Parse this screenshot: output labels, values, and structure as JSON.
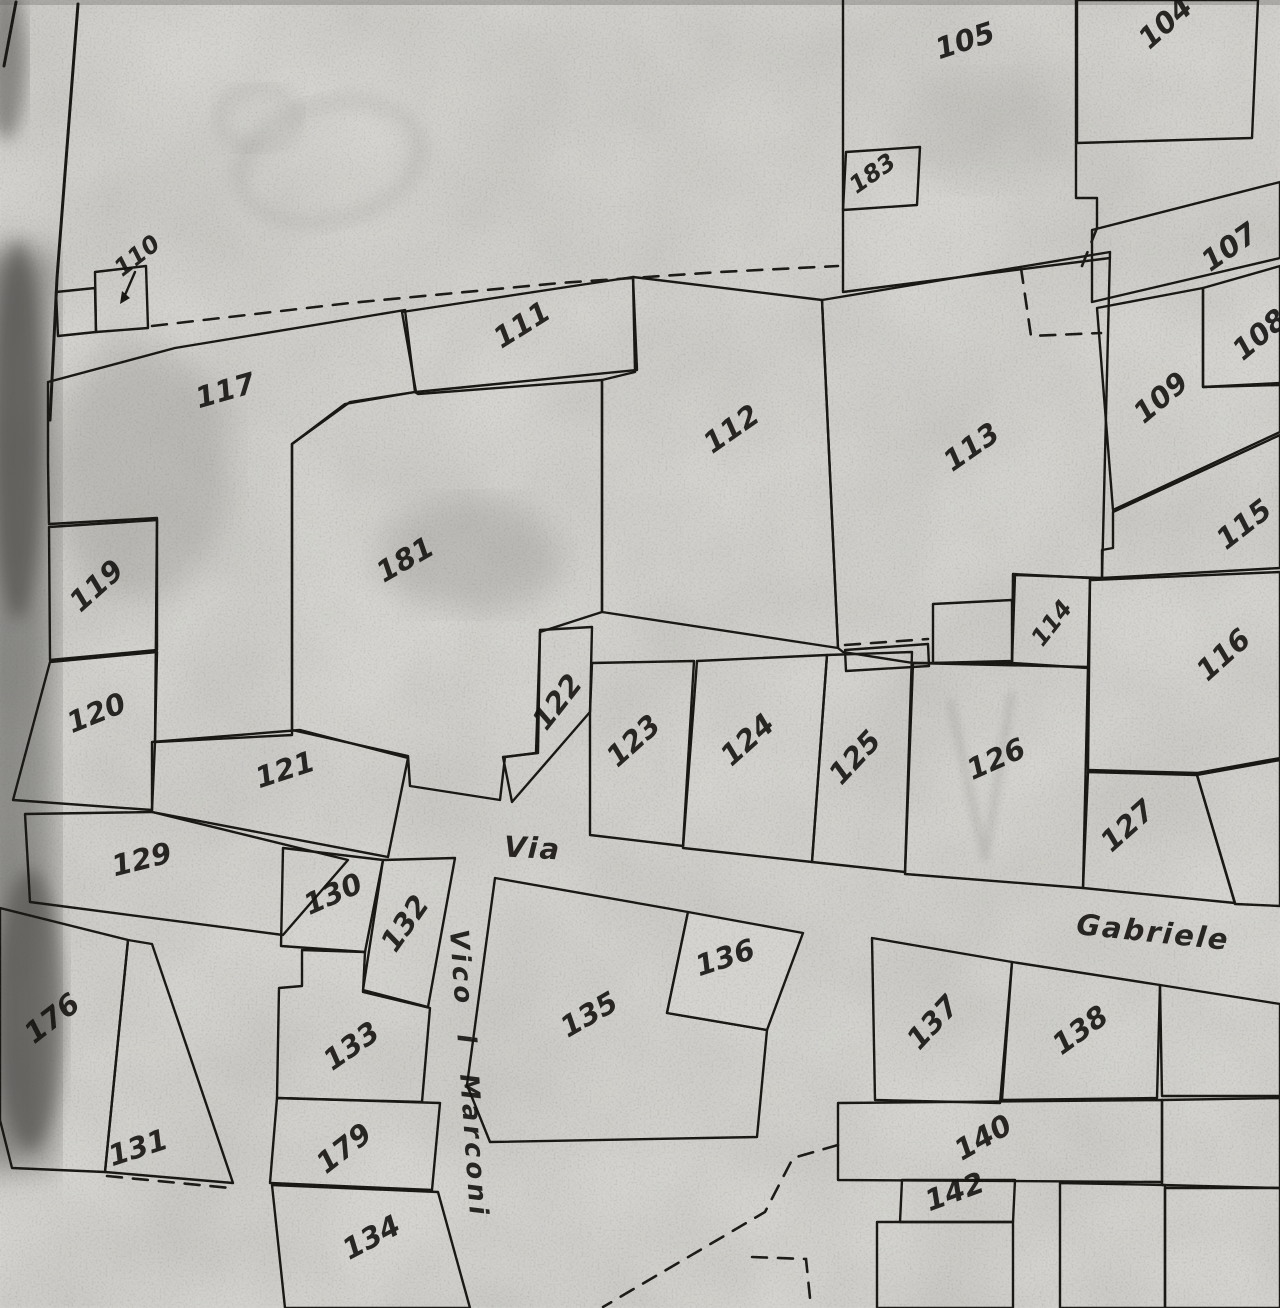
{
  "map": {
    "streets": {
      "via": "Via",
      "gabriele": "Gabriele",
      "vico_marconi": "Vico i Marconi"
    },
    "parcels": [
      {
        "label": "104",
        "hatched": true
      },
      {
        "label": "105",
        "hatched": false
      },
      {
        "label": "183",
        "hatched": true
      },
      {
        "label": "107",
        "hatched": true
      },
      {
        "label": "108",
        "hatched": true
      },
      {
        "label": "109",
        "hatched": true
      },
      {
        "label": "110",
        "hatched": false
      },
      {
        "label": "111",
        "hatched": true
      },
      {
        "label": "112",
        "hatched": false
      },
      {
        "label": "113",
        "hatched": false
      },
      {
        "label": "114",
        "hatched": true
      },
      {
        "label": "115",
        "hatched": true
      },
      {
        "label": "116",
        "hatched": true
      },
      {
        "label": "117",
        "hatched": true
      },
      {
        "label": "119",
        "hatched": true
      },
      {
        "label": "120",
        "hatched": true
      },
      {
        "label": "121",
        "hatched": true
      },
      {
        "label": "122",
        "hatched": true
      },
      {
        "label": "123",
        "hatched": true
      },
      {
        "label": "124",
        "hatched": true
      },
      {
        "label": "125",
        "hatched": true
      },
      {
        "label": "126",
        "hatched": false
      },
      {
        "label": "127",
        "hatched": true
      },
      {
        "label": "129",
        "hatched": true
      },
      {
        "label": "130",
        "hatched": false
      },
      {
        "label": "131",
        "hatched": false
      },
      {
        "label": "132",
        "hatched": true
      },
      {
        "label": "133",
        "hatched": true
      },
      {
        "label": "134",
        "hatched": true
      },
      {
        "label": "135",
        "hatched": true
      },
      {
        "label": "136",
        "hatched": true
      },
      {
        "label": "137",
        "hatched": true
      },
      {
        "label": "138",
        "hatched": true
      },
      {
        "label": "140",
        "hatched": true
      },
      {
        "label": "142",
        "hatched": true
      },
      {
        "label": "176",
        "hatched": false
      },
      {
        "label": "179",
        "hatched": true
      },
      {
        "label": "181",
        "hatched": false
      }
    ]
  },
  "colors": {
    "paper": "#d5d4d0",
    "ink": "#191714",
    "hatch_ink": "#2b2824"
  }
}
